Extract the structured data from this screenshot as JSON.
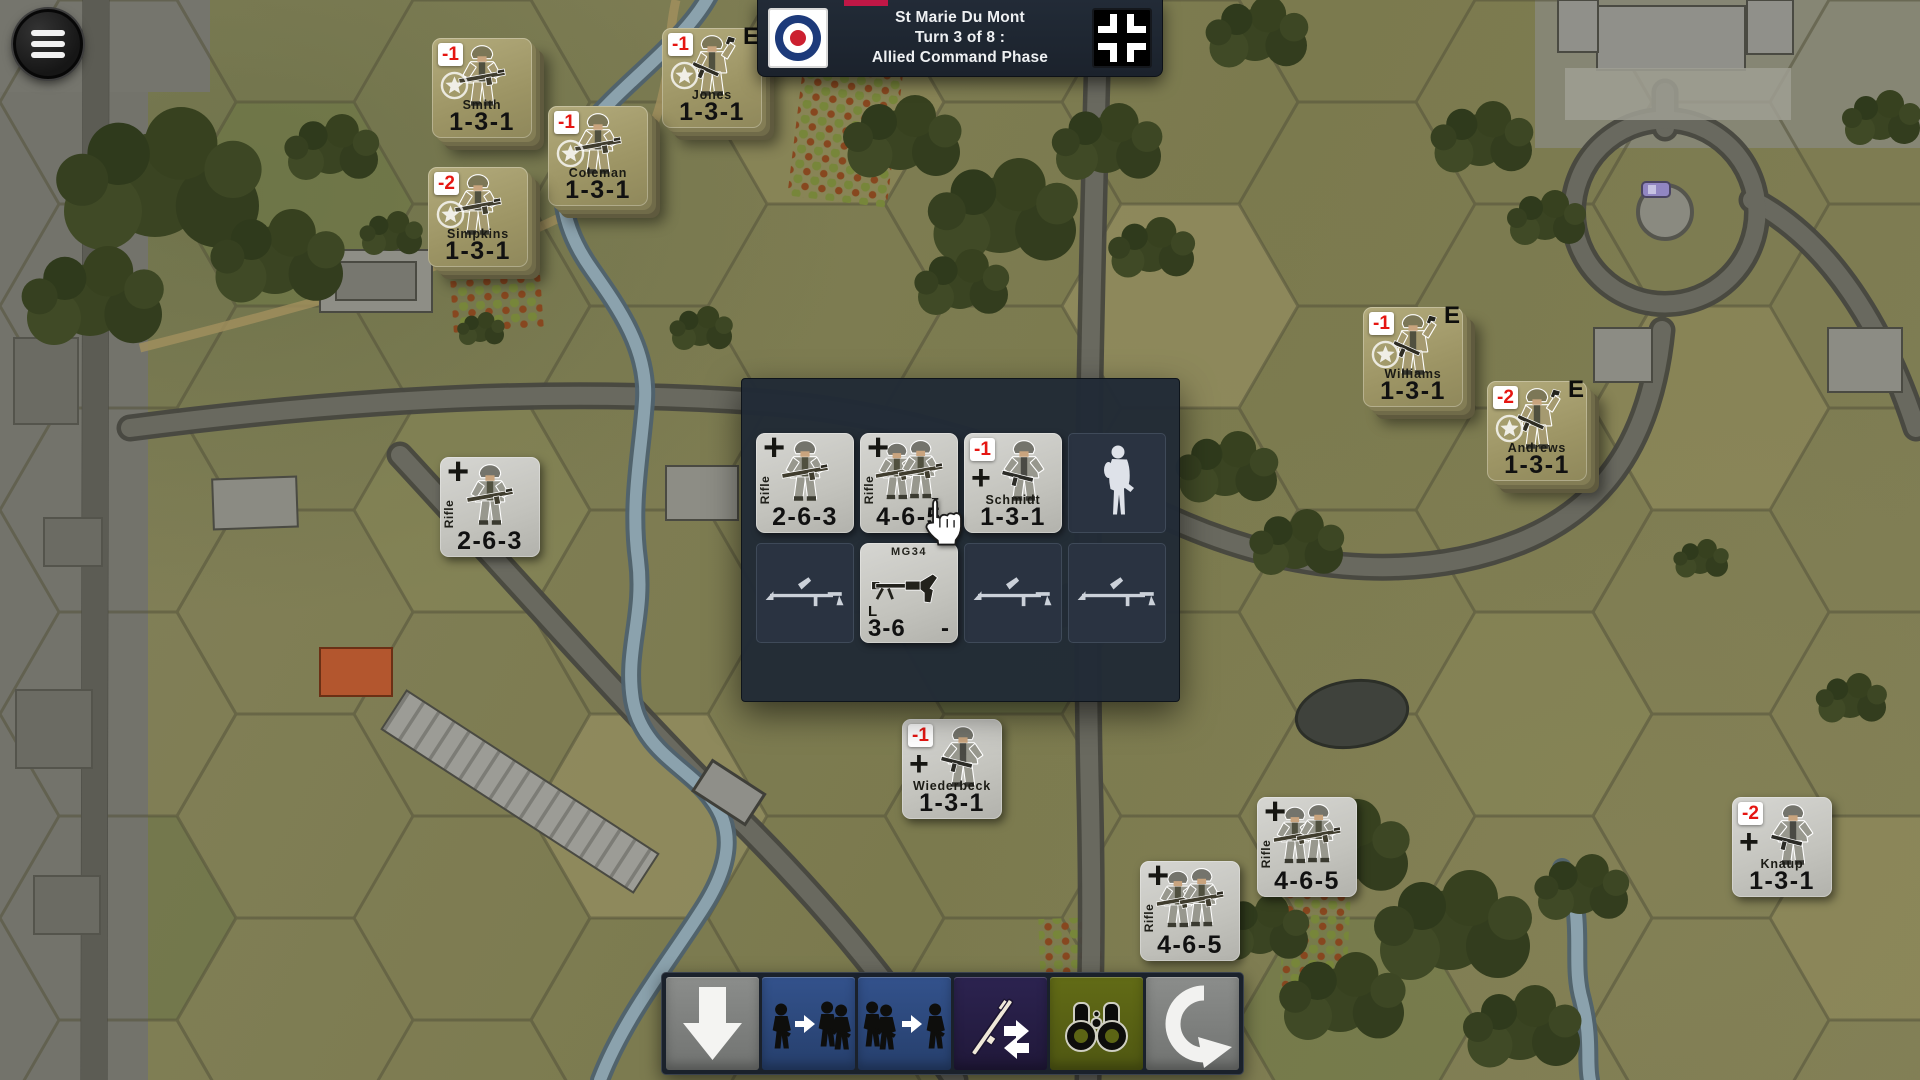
{
  "banner": {
    "location": "St Marie Du Mont",
    "turn": "Turn 3 of 8 :",
    "phase": "Allied Command Phase"
  },
  "colors": {
    "allied_counter": "#a79f6e",
    "german_counter": "#c9c9c5",
    "badge_red": "#e51612",
    "banner_bg": "#1e2733",
    "accent_strip": "#c01746",
    "toolbar_blue": "#2e4d85",
    "toolbar_purple": "#261d41",
    "toolbar_olive": "#5b6414",
    "toolbar_gray": "#7f817f"
  },
  "map_units": [
    {
      "name": "Smith",
      "stats": "1-3-1",
      "badge": "-1"
    },
    {
      "name": "Jones",
      "stats": "1-3-1",
      "badge": "-1",
      "marker": "E"
    },
    {
      "name": "Coleman",
      "stats": "1-3-1",
      "badge": "-1"
    },
    {
      "name": "Simpkins",
      "stats": "1-3-1",
      "badge": "-2"
    },
    {
      "name": "Williams",
      "stats": "1-3-1",
      "badge": "-1",
      "marker": "E"
    },
    {
      "name": "Andrews",
      "stats": "1-3-1",
      "badge": "-2",
      "marker": "E"
    },
    {
      "label": "Rifle",
      "stats": "2-6-3",
      "cross": "+"
    },
    {
      "name": "Wiederbeck",
      "stats": "1-3-1",
      "badge": "-1",
      "cross": "+"
    },
    {
      "label": "Rifle",
      "stats": "4-6-5",
      "cross": "+"
    },
    {
      "label": "Rifle",
      "stats": "4-6-5",
      "cross": "+"
    },
    {
      "name": "Knaup",
      "stats": "1-3-1",
      "badge": "-2",
      "cross": "+"
    }
  ],
  "stack_panel": {
    "units": [
      {
        "label": "Rifle",
        "stats": "2-6-3",
        "cross": "+"
      },
      {
        "label": "Rifle",
        "stats": "4-6-5",
        "cross": "+"
      },
      {
        "name": "Schmidt",
        "stats": "1-3-1",
        "badge": "-1",
        "cross": "+"
      }
    ],
    "weapon": {
      "title": "MG34",
      "class_code": "L",
      "factor": "3-6",
      "status": "-"
    }
  },
  "toolbar": {
    "buttons": [
      {
        "id": "move-down",
        "icon": "down-arrow"
      },
      {
        "id": "join-units",
        "icon": "soldier-merge"
      },
      {
        "id": "split-units",
        "icon": "soldier-split"
      },
      {
        "id": "transfer-weapons",
        "icon": "rifle-swap"
      },
      {
        "id": "spot-recon",
        "icon": "binoculars"
      },
      {
        "id": "end-phase",
        "icon": "undo-arrow"
      }
    ]
  }
}
